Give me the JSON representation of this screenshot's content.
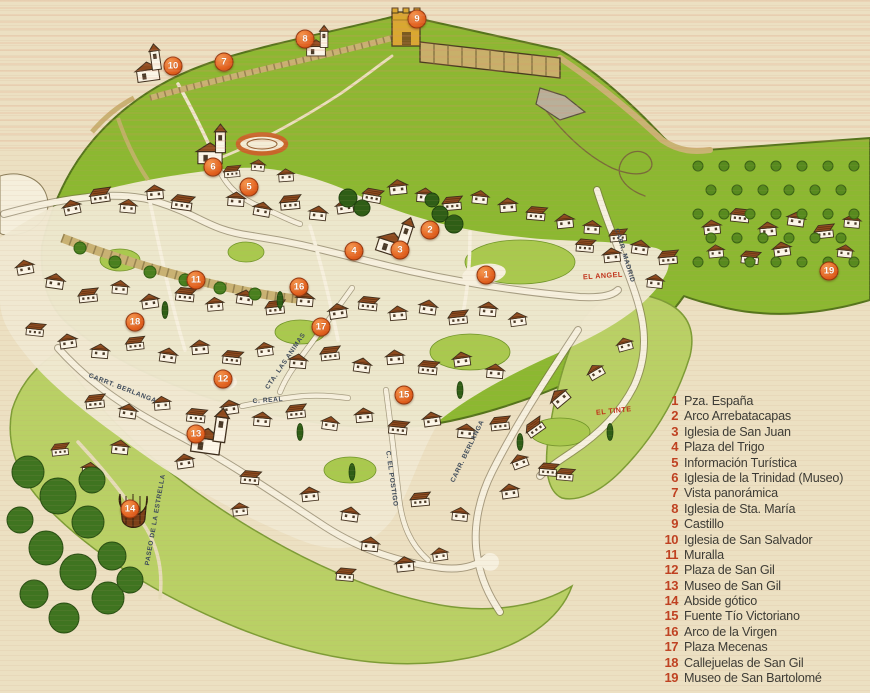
{
  "legend": {
    "items": [
      {
        "n": "1",
        "label": "Pza. España"
      },
      {
        "n": "2",
        "label": "Arco Arrebatacapas"
      },
      {
        "n": "3",
        "label": "Iglesia de San Juan"
      },
      {
        "n": "4",
        "label": "Plaza del Trigo"
      },
      {
        "n": "5",
        "label": "Información Turística"
      },
      {
        "n": "6",
        "label": "Iglesia de la Trinidad (Museo)"
      },
      {
        "n": "7",
        "label": "Vista panorámica"
      },
      {
        "n": "8",
        "label": "Iglesia de Sta. María"
      },
      {
        "n": "9",
        "label": "Castillo"
      },
      {
        "n": "10",
        "label": "Iglesia de San Salvador"
      },
      {
        "n": "11",
        "label": "Muralla"
      },
      {
        "n": "12",
        "label": "Plaza de San Gil"
      },
      {
        "n": "13",
        "label": "Museo de San Gil"
      },
      {
        "n": "14",
        "label": "Abside gótico"
      },
      {
        "n": "15",
        "label": "Fuente Tío Victoriano"
      },
      {
        "n": "16",
        "label": "Arco de la Virgen"
      },
      {
        "n": "17",
        "label": "Plaza Mecenas"
      },
      {
        "n": "18",
        "label": "Callejuelas de San Gil"
      },
      {
        "n": "19",
        "label": "Museo de San Bartolomé"
      }
    ]
  },
  "map": {
    "markers": [
      {
        "n": "1",
        "x": 486,
        "y": 275
      },
      {
        "n": "2",
        "x": 430,
        "y": 230
      },
      {
        "n": "3",
        "x": 400,
        "y": 250
      },
      {
        "n": "4",
        "x": 354,
        "y": 251
      },
      {
        "n": "5",
        "x": 249,
        "y": 187
      },
      {
        "n": "6",
        "x": 213,
        "y": 167
      },
      {
        "n": "7",
        "x": 224,
        "y": 62
      },
      {
        "n": "8",
        "x": 305,
        "y": 39
      },
      {
        "n": "9",
        "x": 417,
        "y": 19
      },
      {
        "n": "10",
        "x": 173,
        "y": 66
      },
      {
        "n": "11",
        "x": 196,
        "y": 280
      },
      {
        "n": "12",
        "x": 223,
        "y": 379
      },
      {
        "n": "13",
        "x": 196,
        "y": 434
      },
      {
        "n": "14",
        "x": 130,
        "y": 509
      },
      {
        "n": "15",
        "x": 404,
        "y": 395
      },
      {
        "n": "16",
        "x": 299,
        "y": 287
      },
      {
        "n": "17",
        "x": 321,
        "y": 327
      },
      {
        "n": "18",
        "x": 135,
        "y": 322
      },
      {
        "n": "19",
        "x": 829,
        "y": 271
      }
    ],
    "street_labels": [
      {
        "text": "CARRT. BERLANGA",
        "x": 122,
        "y": 390,
        "rot": 21
      },
      {
        "text": "CARR. BERLANGA",
        "x": 469,
        "y": 452,
        "rot": -64
      },
      {
        "text": "C. EL POSTIGO",
        "x": 390,
        "y": 479,
        "rot": 82
      },
      {
        "text": "CTA. LAS ANIMAS",
        "x": 287,
        "y": 362,
        "rot": -56
      },
      {
        "text": "C. REAL",
        "x": 268,
        "y": 402,
        "rot": -4
      },
      {
        "text": "CARR. MADRID",
        "x": 623,
        "y": 256,
        "rot": 73
      },
      {
        "text": "PASEO DE LA ESTRELLA",
        "x": 157,
        "y": 520,
        "rot": -80
      }
    ],
    "place_labels": [
      {
        "text": "EL TINTE",
        "x": 614,
        "y": 413,
        "rot": -6
      },
      {
        "text": "EL ANGEL",
        "x": 603,
        "y": 278,
        "rot": -4
      }
    ]
  },
  "colors": {
    "paper": "#ece0c2",
    "hill_green": "#8cb831",
    "field_green": "#b9d065",
    "roof_brown": "#8d4a1e",
    "castle_tan": "#c8b06a",
    "marker_orange": "#e2611f",
    "legend_number": "#bf4020",
    "legend_text": "#3b3a34",
    "street_label": "#3d4a5a",
    "place_label": "#c03018",
    "bullring_ring": "#c8662a"
  }
}
